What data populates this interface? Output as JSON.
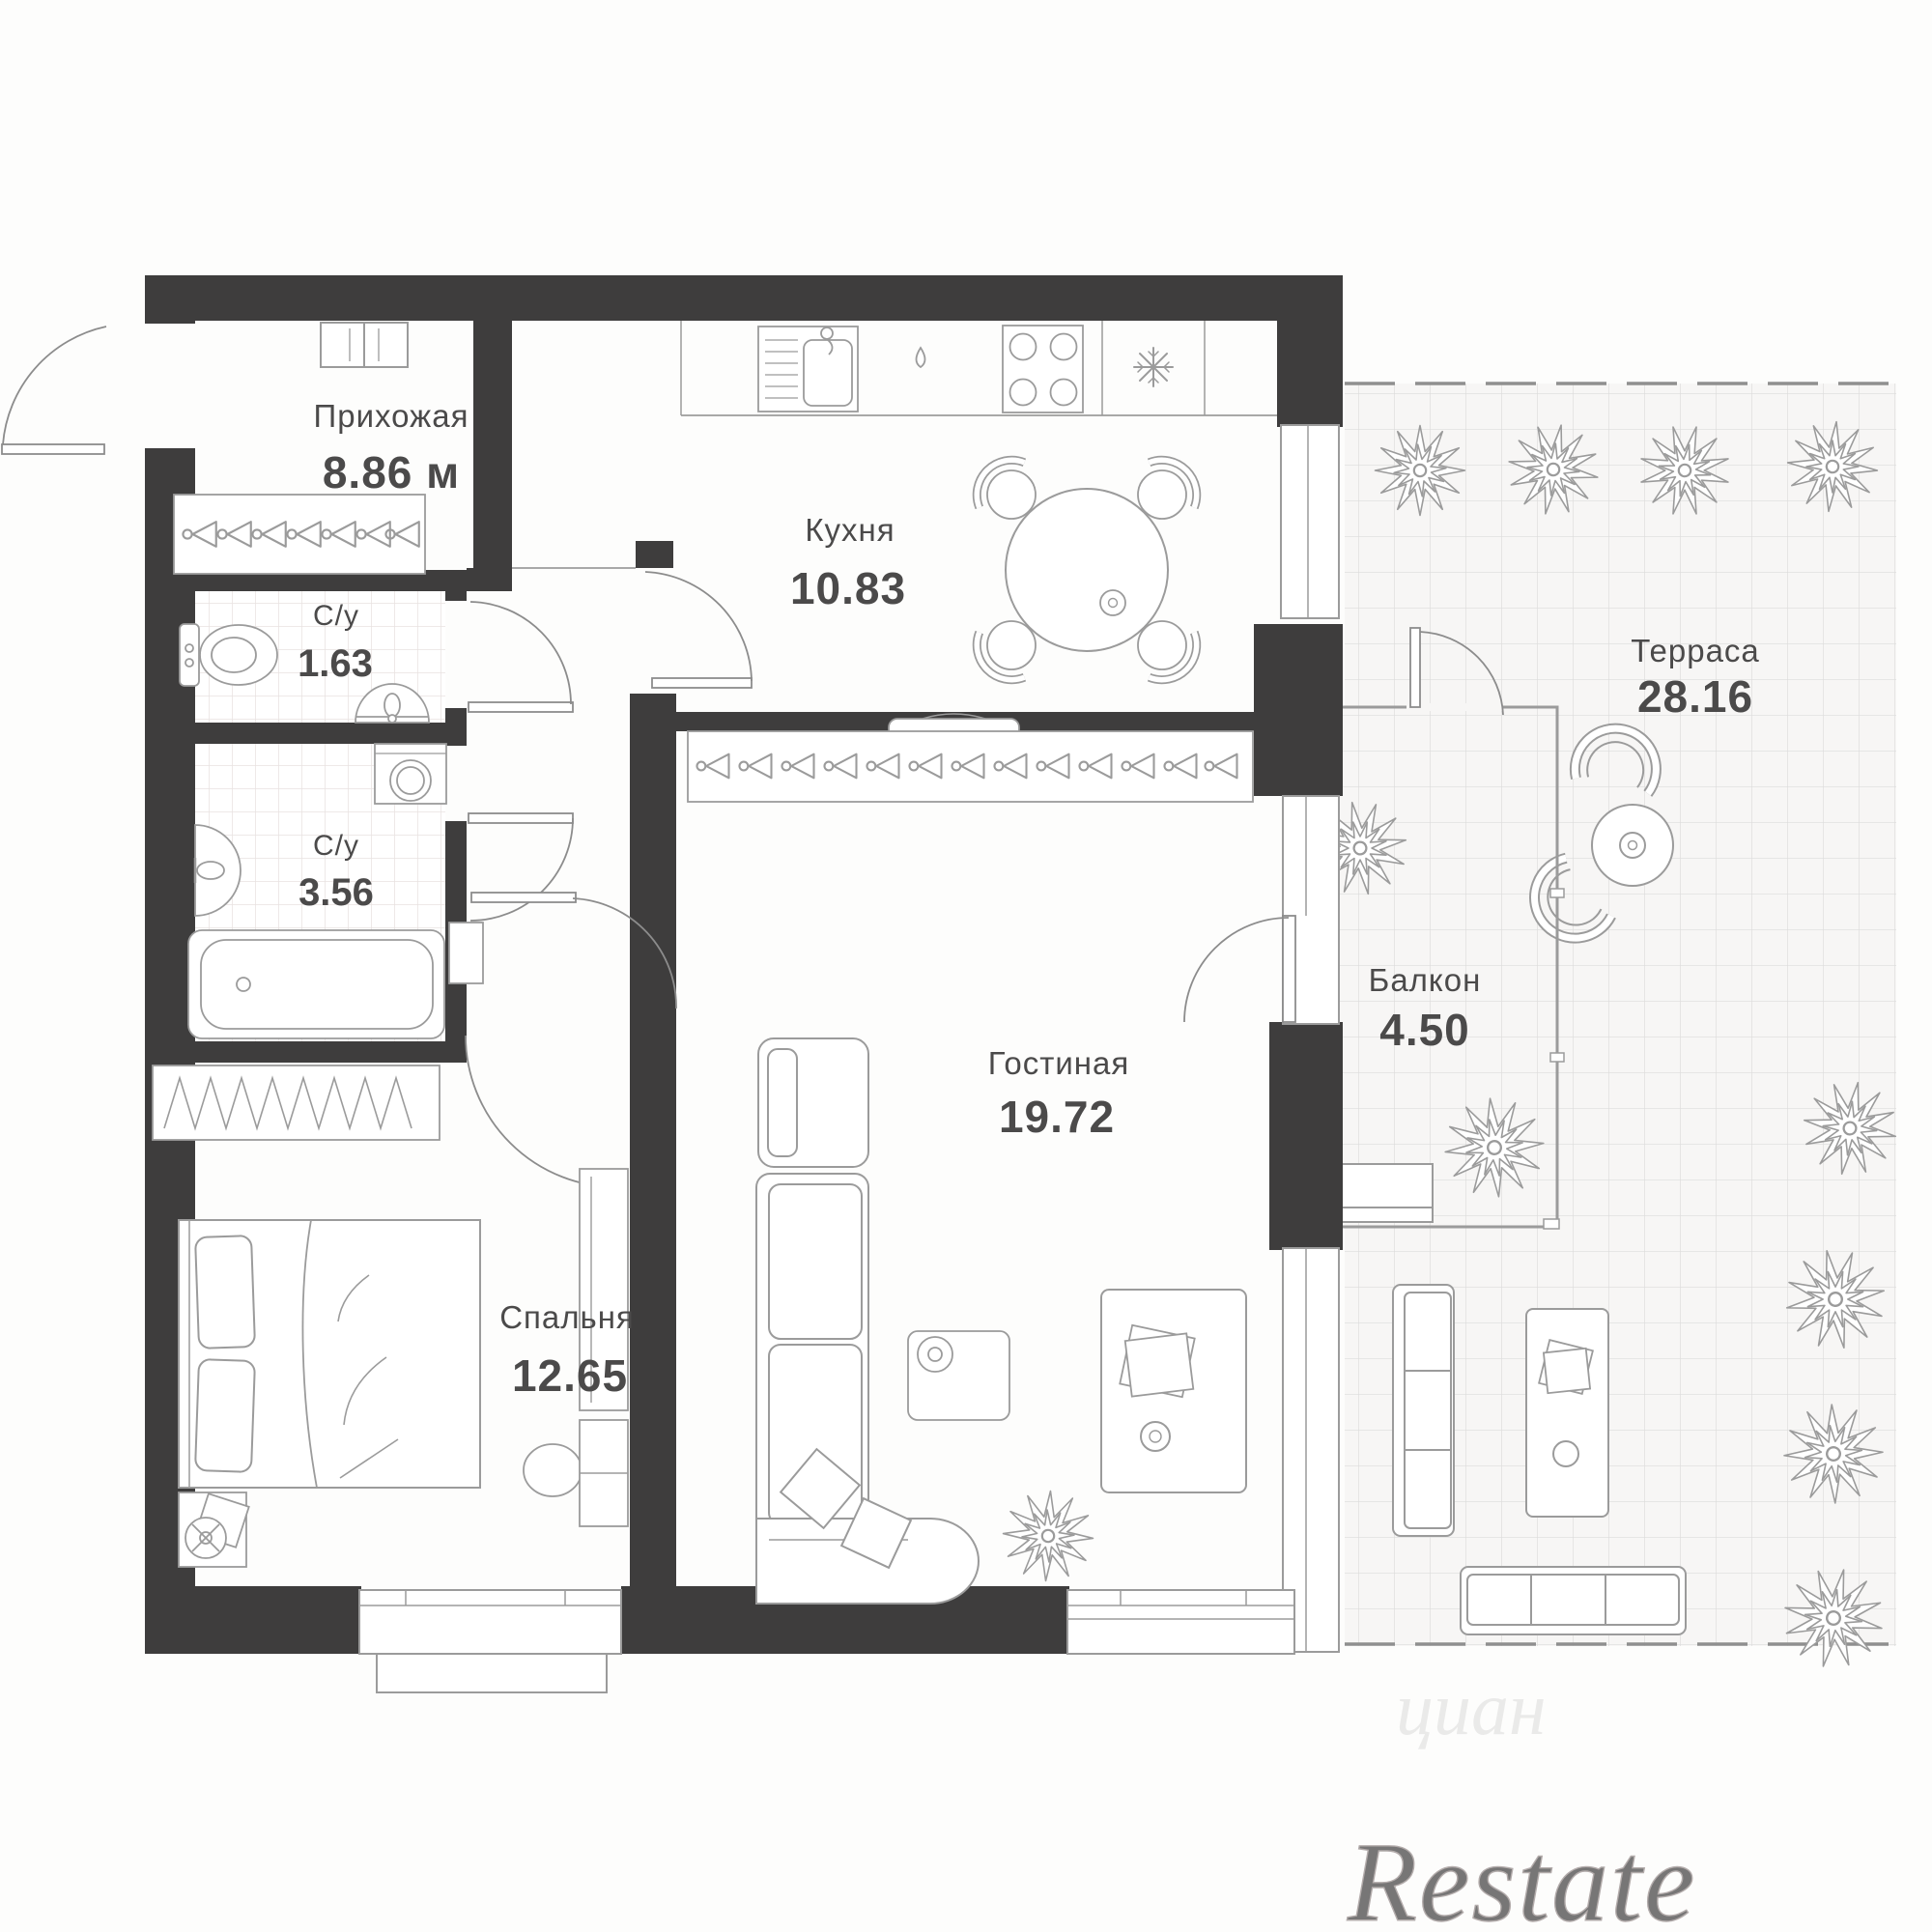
{
  "plan": {
    "title": "apartment-floor-plan",
    "rooms": [
      {
        "name": "Прихожая",
        "area": "8.86 м"
      },
      {
        "name": "Кухня",
        "area": "10.83"
      },
      {
        "name": "С/у",
        "area": "1.63"
      },
      {
        "name": "С/у",
        "area": "3.56"
      },
      {
        "name": "Гостиная",
        "area": "19.72"
      },
      {
        "name": "Спальня",
        "area": "12.65"
      },
      {
        "name": "Балкон",
        "area": "4.50"
      },
      {
        "name": "Терраса",
        "area": "28.16"
      }
    ],
    "watermark": "Restate",
    "watermark_faint": "циан",
    "colors": {
      "wall": "#3e3d3d",
      "furniture_line": "#9b9b9b",
      "label_text": "#4b4a4a",
      "tile_line": "#e8e2e1",
      "terrace_grid_line": "#dcdcdc",
      "terrace_bg": "#f7f6f5",
      "watermark_gray": "#9b9191"
    }
  }
}
